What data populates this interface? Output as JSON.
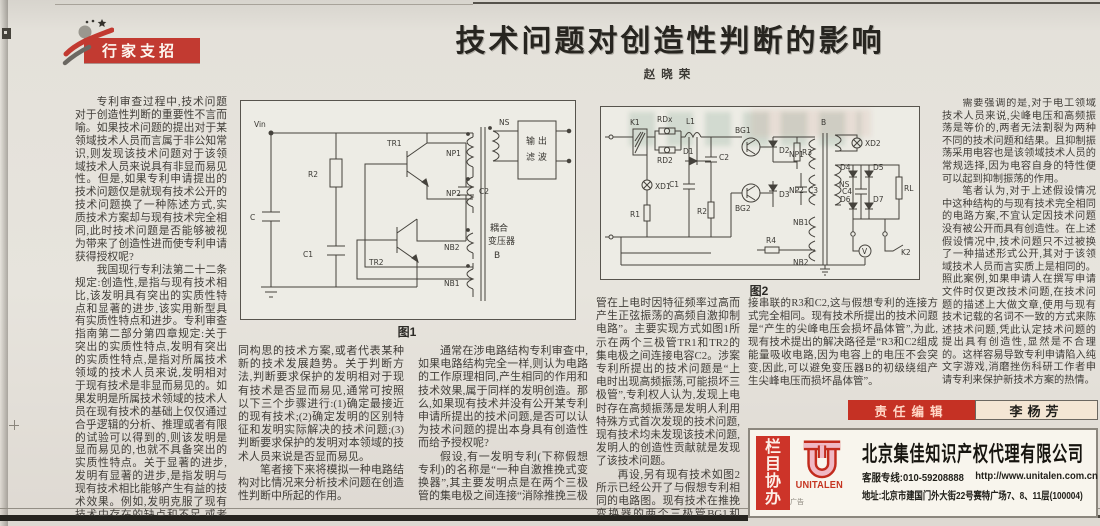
{
  "masthead": {
    "badge": "行家支招"
  },
  "article": {
    "title": "技术问题对创造性判断的影响",
    "author": "赵晓荣"
  },
  "columns": {
    "col1": {
      "p1": "专利审查过程中,技术问题对于创造性判断的重要性不言而喻。如果技术问题的提出对于某领域技术人员而言属于非公知常识,则发现该技术问题对于该领域技术人员来说具有非显而易见性。但是,如果专利申请提出的技术问题仅是就现有技术公开的技术问题换了一种陈述方式,实质技术方案却与现有技术完全相同,此时技术问题是否能够被视为带来了创造性进而使专利申请获得授权呢?",
      "p2": "我国现行专利法第二十二条规定:创造性,是指与现有技术相比,该发明具有突出的实质性特点和显著的进步,该实用新型具有实质性特点和进步。专利审查指南第二部分第四章规定:关于突出的实质性特点,发明有突出的实质性特点,是指对所属技术领域的技术人员来说,发明相对于现有技术是非显而易见的。如果发明是所属技术领域的技术人员在现有技术的基础上仅仅通过合乎逻辑的分析、推理或者有限的试验可以得到的,则该发明是显而易见的,也就不具备突出的实质性特点。关于显著的进步,发明有显著的进步,是指发明与现有技术相比能够产生有益的技术效果。例如,发明克服了现有技术中存在的缺点和不足,或者为解决某一技术问题提供了一种不"
    },
    "col2": {
      "p1": "同构思的技术方案,或者代表某种新的技术发展趋势。关于判断方法,判断要求保护的发明相对于现有技术是否显而易见,通常可按照以下三个步骤进行:(1)确定最接近的现有技术;(2)确定发明的区别特征和发明实际解决的技术问题;(3)判断要求保护的发明对本领域的技术人员来说是否显而易见。",
      "p2": "笔者接下来将模拟一种电路结构对比情况来分析技术问题在创造性判断中所起的作用。"
    },
    "col3": {
      "p1": "通常在涉电路结构专利审查中,如果电路结构完全一样,则认为电路的工作原理相同,产生相同的作用和技术效果,属于同样的发明创造。那么,如果现有技术并没有公开某专利申请所提出的技术问题,是否可以认为技术问题的提出本身具有创造性而给予授权呢?",
      "p2": "假设,有一发明专利(下称假想专利)的名称是“一种自激推挽式变换器”,其主要发明点是在两个三极管的集电极之间连接“消除推挽三极"
    },
    "col4": {
      "p1": "管在上电时因特征频率过高而产生正弦振荡的高频自激抑制电路”。主要实现方式如图1所示在两个三极管TR1和TR2的集电极之间连接电容C2。涉案专利所提出的技术问题是“上电时出现高频振荡,可能损坏三极管”,专利权人认为,发现上电时存在高频振荡是发明人利用特殊方式首次发现的技术问题,现有技术均未发现该技术问题,发明人的创造性贡献就是发现了该技术问题。",
      "p2": "再设,另有现有技术如图2所示已经公开了与假想专利相同的电路图。现有技术在推挽变换器的两个三极管BG1和BG2的集电极之间连"
    },
    "col5": {
      "p1": "接串联的R3和C2,这与假想专利的连接方式完全相同。现有技术所提出的技术问题是“产生的尖峰电压会损坏晶体管”,为此,现有技术提出的解决路径是“R3和C2组成能量吸收电路,因为电容上的电压不会突变,因此,可以避免变压器B的初级绕组产生尖峰电压而损坏晶体管”。"
    },
    "col6": {
      "p1": "需要强调的是,对于电工领域技术人员来说,尖峰电压和高频振荡是等价的,两者无法割裂为两种不同的技术问题和结果。且抑制振荡采用电容也是该领域技术人员的常规选择,因为电容自身的特性便可以起到抑制振荡的作用。",
      "p2": "笔者认为,对于上述假设情况中这种结构的与现有技术完全相同的电路方案,不宜认定因技术问题没有被公开而具有创造性。在上述假设情况中,技术问题只不过被换了一种描述形式公开,其对于该领域技术人员而言实质上是相同的。照此案例,如果申请人在撰写申请文件时仅更改技术问题,在技术问题的描述上大做文章,使用与现有技术记载的名词不一致的方式来陈述技术问题,凭此认定技术问题的提出具有创造性,显然是不合理的。这样容易导致专利申请陷入纯文字游戏,消磨挫伤科研工作者申请专利来保护新技术方案的热情。"
    }
  },
  "fig1": {
    "caption": "图1",
    "labels": {
      "vin": "Vin",
      "c": "C",
      "r2": "R2",
      "c1": "C1",
      "tr1": "TR1",
      "tr2": "TR2",
      "c2": "C2",
      "np1": "NP1",
      "np2": "NP2",
      "nb2": "NB2",
      "nb1": "NB1",
      "ns": "NS",
      "filter_line1": "输 出",
      "filter_line2": "滤 波",
      "coupling_line1": "耦合",
      "coupling_line2": "变压器",
      "coupling_line3": "B"
    }
  },
  "fig2": {
    "caption": "图2",
    "labels": {
      "k1": "K1",
      "rdx": "RDx",
      "rd2": "RD2",
      "l1": "L1",
      "d1": "D1",
      "xd1": "XD1",
      "r1": "R1",
      "c1": "C1",
      "c2": "C2",
      "r2": "R2",
      "bg1": "BG1",
      "bg2": "BG2",
      "d2": "D2",
      "d3": "D3",
      "r3": "R3",
      "c3": "C3",
      "b": "B",
      "np1": "NP1",
      "np2": "NP2",
      "ns": "NS",
      "nb1": "NB1",
      "nb2": "NB2",
      "r4": "R4",
      "xd2": "XD2",
      "d4": "D4",
      "d5": "D5",
      "d6": "D6",
      "d7": "D7",
      "c4": "C4",
      "rl": "RL",
      "v": "V",
      "k2": "K2"
    }
  },
  "editor": {
    "label": "责任编辑",
    "name": "李杨芳"
  },
  "ad": {
    "strip_chars": [
      "栏",
      "目",
      "协",
      "办"
    ],
    "logo_text": "UNITALEN",
    "ad_mark": "广告",
    "company": "北京集佳知识产权代理有限公司",
    "hotline": "客服专线:010-59208888",
    "website": "http://www.unitalen.com.cn",
    "address": "地址:北京市建国门外大街22号赛特广场7、8、11层(100004)"
  }
}
